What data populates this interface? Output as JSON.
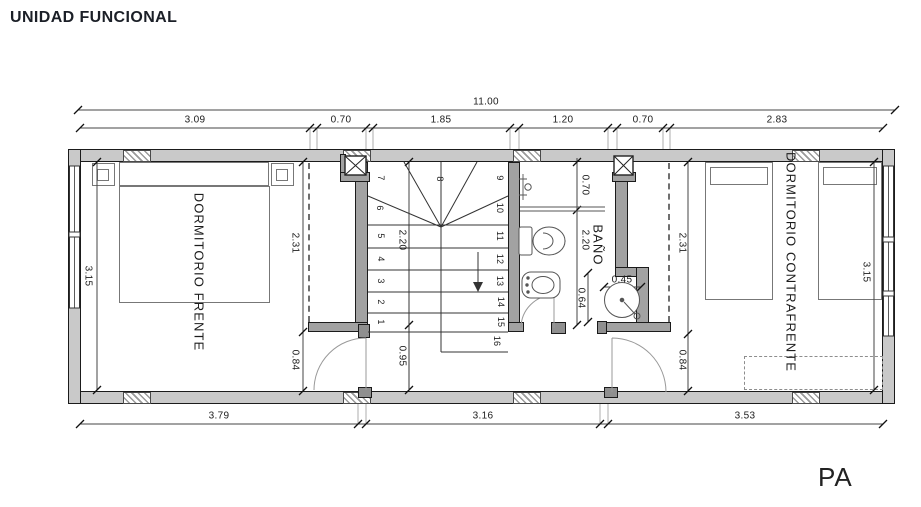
{
  "title": "UNIDAD FUNCIONAL",
  "sheet_label": "PA",
  "rooms": {
    "front_bedroom": "DORMITORIO FRENTE",
    "bathroom": "BAÑO",
    "back_bedroom": "DORMITORIO CONTRAFRENTE"
  },
  "dimensions": {
    "overall_width": "11.00",
    "top_segments": [
      "3.09",
      "0.70",
      "1.85",
      "1.20",
      "0.70",
      "2.83"
    ],
    "bottom_segments": [
      "3.79",
      "3.16",
      "3.53"
    ],
    "left_height": "3.15",
    "right_height": "3.15",
    "front_closet_depth": "2.31",
    "front_door_zone": "0.84",
    "stair_run": "2.20",
    "landing_width": "0.95",
    "bath_shower_width": "0.70",
    "bath_length": "2.20",
    "vanity_opening": "0.64",
    "sink_diameter": "0.45",
    "back_closet_depth": "2.31",
    "back_door_zone": "0.84"
  },
  "stairs": {
    "steps": [
      "1",
      "2",
      "3",
      "4",
      "5",
      "6",
      "7",
      "8",
      "9",
      "10",
      "11",
      "12",
      "13",
      "14",
      "15",
      "16"
    ]
  }
}
